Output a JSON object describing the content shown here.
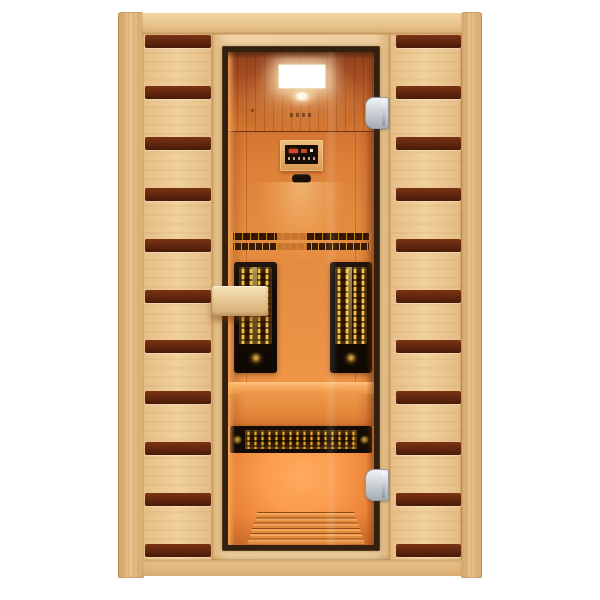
{
  "meta": {
    "type": "product-photo",
    "subject": "Two-person infrared sauna cabin, front view: light hemlock wood cabinet with dark walnut accent stripes, full-height glass door, warm orange-lit interior",
    "canvas": "600x600"
  },
  "palette": {
    "bg": "#ffffff",
    "wood_light": "#f0d09c",
    "wood_post": "#e9c18e",
    "frame_wood": "#f0d2a2",
    "stripe_color": "#5a220c",
    "door_dark": "#33210f",
    "glass_mid": "#ea9044",
    "heater_black": "#150c05",
    "element_gold": "#eec24a",
    "hinge_silver": "#c6ccd2",
    "handle_wood": "#e3c18c",
    "light_panel": "#ffffff"
  },
  "structure": {
    "left_panel_stripes": 11,
    "right_panel_stripes": 11,
    "hinge_count": 2,
    "vertical_heaters": 2,
    "bench_heaters": 1,
    "backrest_slat_rows": 2,
    "floor_grate_slats": 6,
    "ceiling_lights": 2,
    "control_panel": 1
  }
}
